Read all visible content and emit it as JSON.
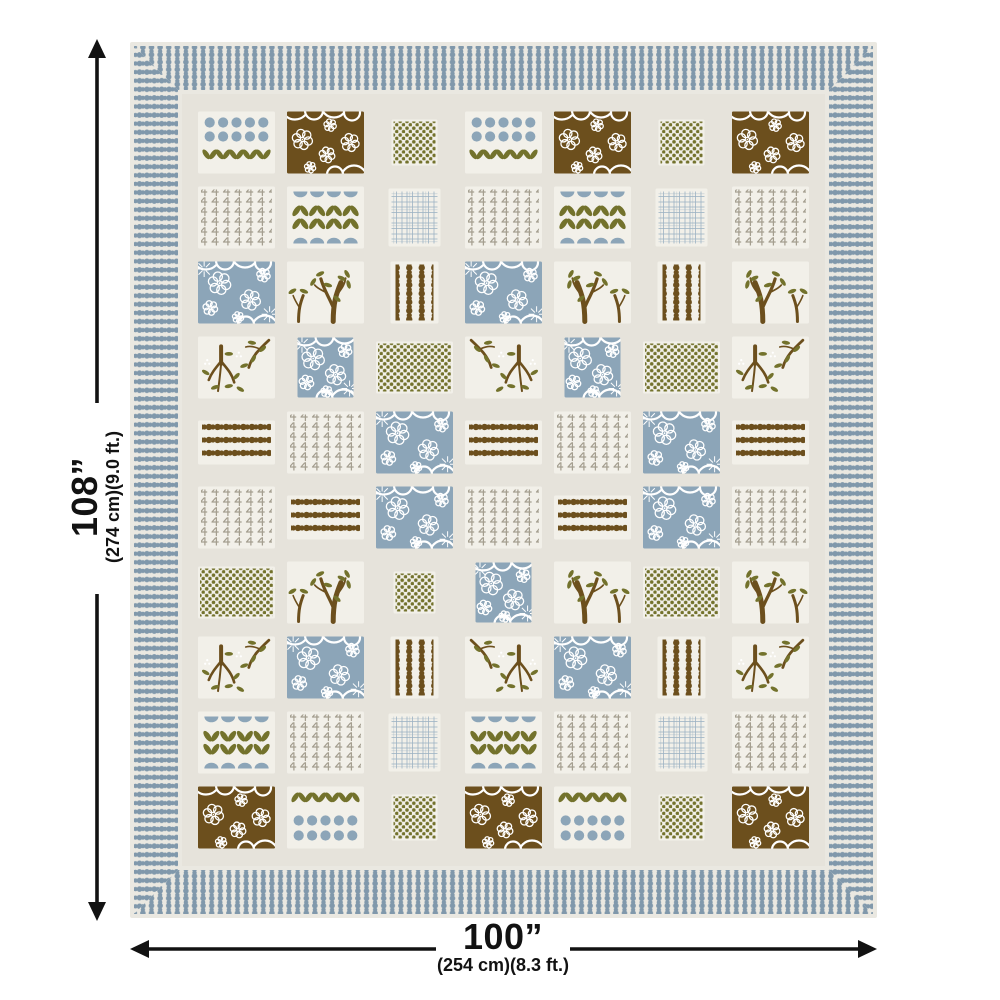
{
  "page": {
    "type": "product-dimension-diagram",
    "subject": "patchwork quilt / bedspread with beaded stripe border",
    "background": "#ffffff"
  },
  "dimensions": {
    "height": {
      "label": "108”",
      "sub": "(274 cm)(9.0 ft.)"
    },
    "width": {
      "label": "100”",
      "sub": "(254 cm)(8.3 ft.)"
    }
  },
  "colors": {
    "blue": "#8CA5B8",
    "border_blue": "#8098AB",
    "olive": "#73722C",
    "brown": "#6C4F1D",
    "taupe": "#A49E8F",
    "cream": "#EAE8E1",
    "field": "#E6E3DB",
    "patch_bg": "#F2F0E9",
    "hatch": "#9DB3C4",
    "arrow": "#121212",
    "white": "#FFFFFF"
  },
  "quilt": {
    "border_style": "beaded-stripe-border-mitered-corners",
    "patch_types": {
      "dt": "blue-dots-with-olive-tulips",
      "td": "olive-chevrons-with-blue-dots",
      "bf": "brown-floral",
      "blf": "blue-floral",
      "blfs": "blue-floral-small",
      "od": "olive-dots-square",
      "ods": "olive-dots-small",
      "odw": "olive-dots-wide",
      "sp": "taupe-sprigs",
      "hm": "blue-halfmoons-olive-wings",
      "hm2": "blue-halfmoons-olive-wings-flipped",
      "ch": "blue-crosshatch",
      "bc": "brown-bead-columns",
      "brr": "brown-bead-rows",
      "br": "branches-with-leaves",
      "tr": "trees-with-leaves"
    },
    "grid": {
      "cols": 7,
      "rows": [
        [
          "dt",
          "bf",
          "od",
          "dt",
          "bf",
          "od",
          "bf"
        ],
        [
          "sp",
          "hm",
          "ch",
          "sp",
          "hm",
          "ch",
          "sp"
        ],
        [
          "blf",
          "tr",
          "bc",
          "blf",
          "tr",
          "bc",
          "tr"
        ],
        [
          "br",
          "blfs",
          "odw",
          "br",
          "blfs",
          "odw",
          "br"
        ],
        [
          "brr",
          "sp",
          "blf",
          "brr",
          "sp",
          "blf",
          "brr"
        ],
        [
          "sp",
          "brr",
          "blf",
          "sp",
          "brr",
          "blf",
          "sp"
        ],
        [
          "odw",
          "tr",
          "ods",
          "blfs",
          "tr",
          "odw",
          "tr"
        ],
        [
          "br",
          "blf",
          "bc",
          "br",
          "blf",
          "bc",
          "br"
        ],
        [
          "hm2",
          "sp",
          "ch",
          "hm2",
          "sp",
          "ch",
          "sp"
        ],
        [
          "bf",
          "td",
          "od",
          "bf",
          "td",
          "od",
          "bf"
        ]
      ]
    }
  }
}
